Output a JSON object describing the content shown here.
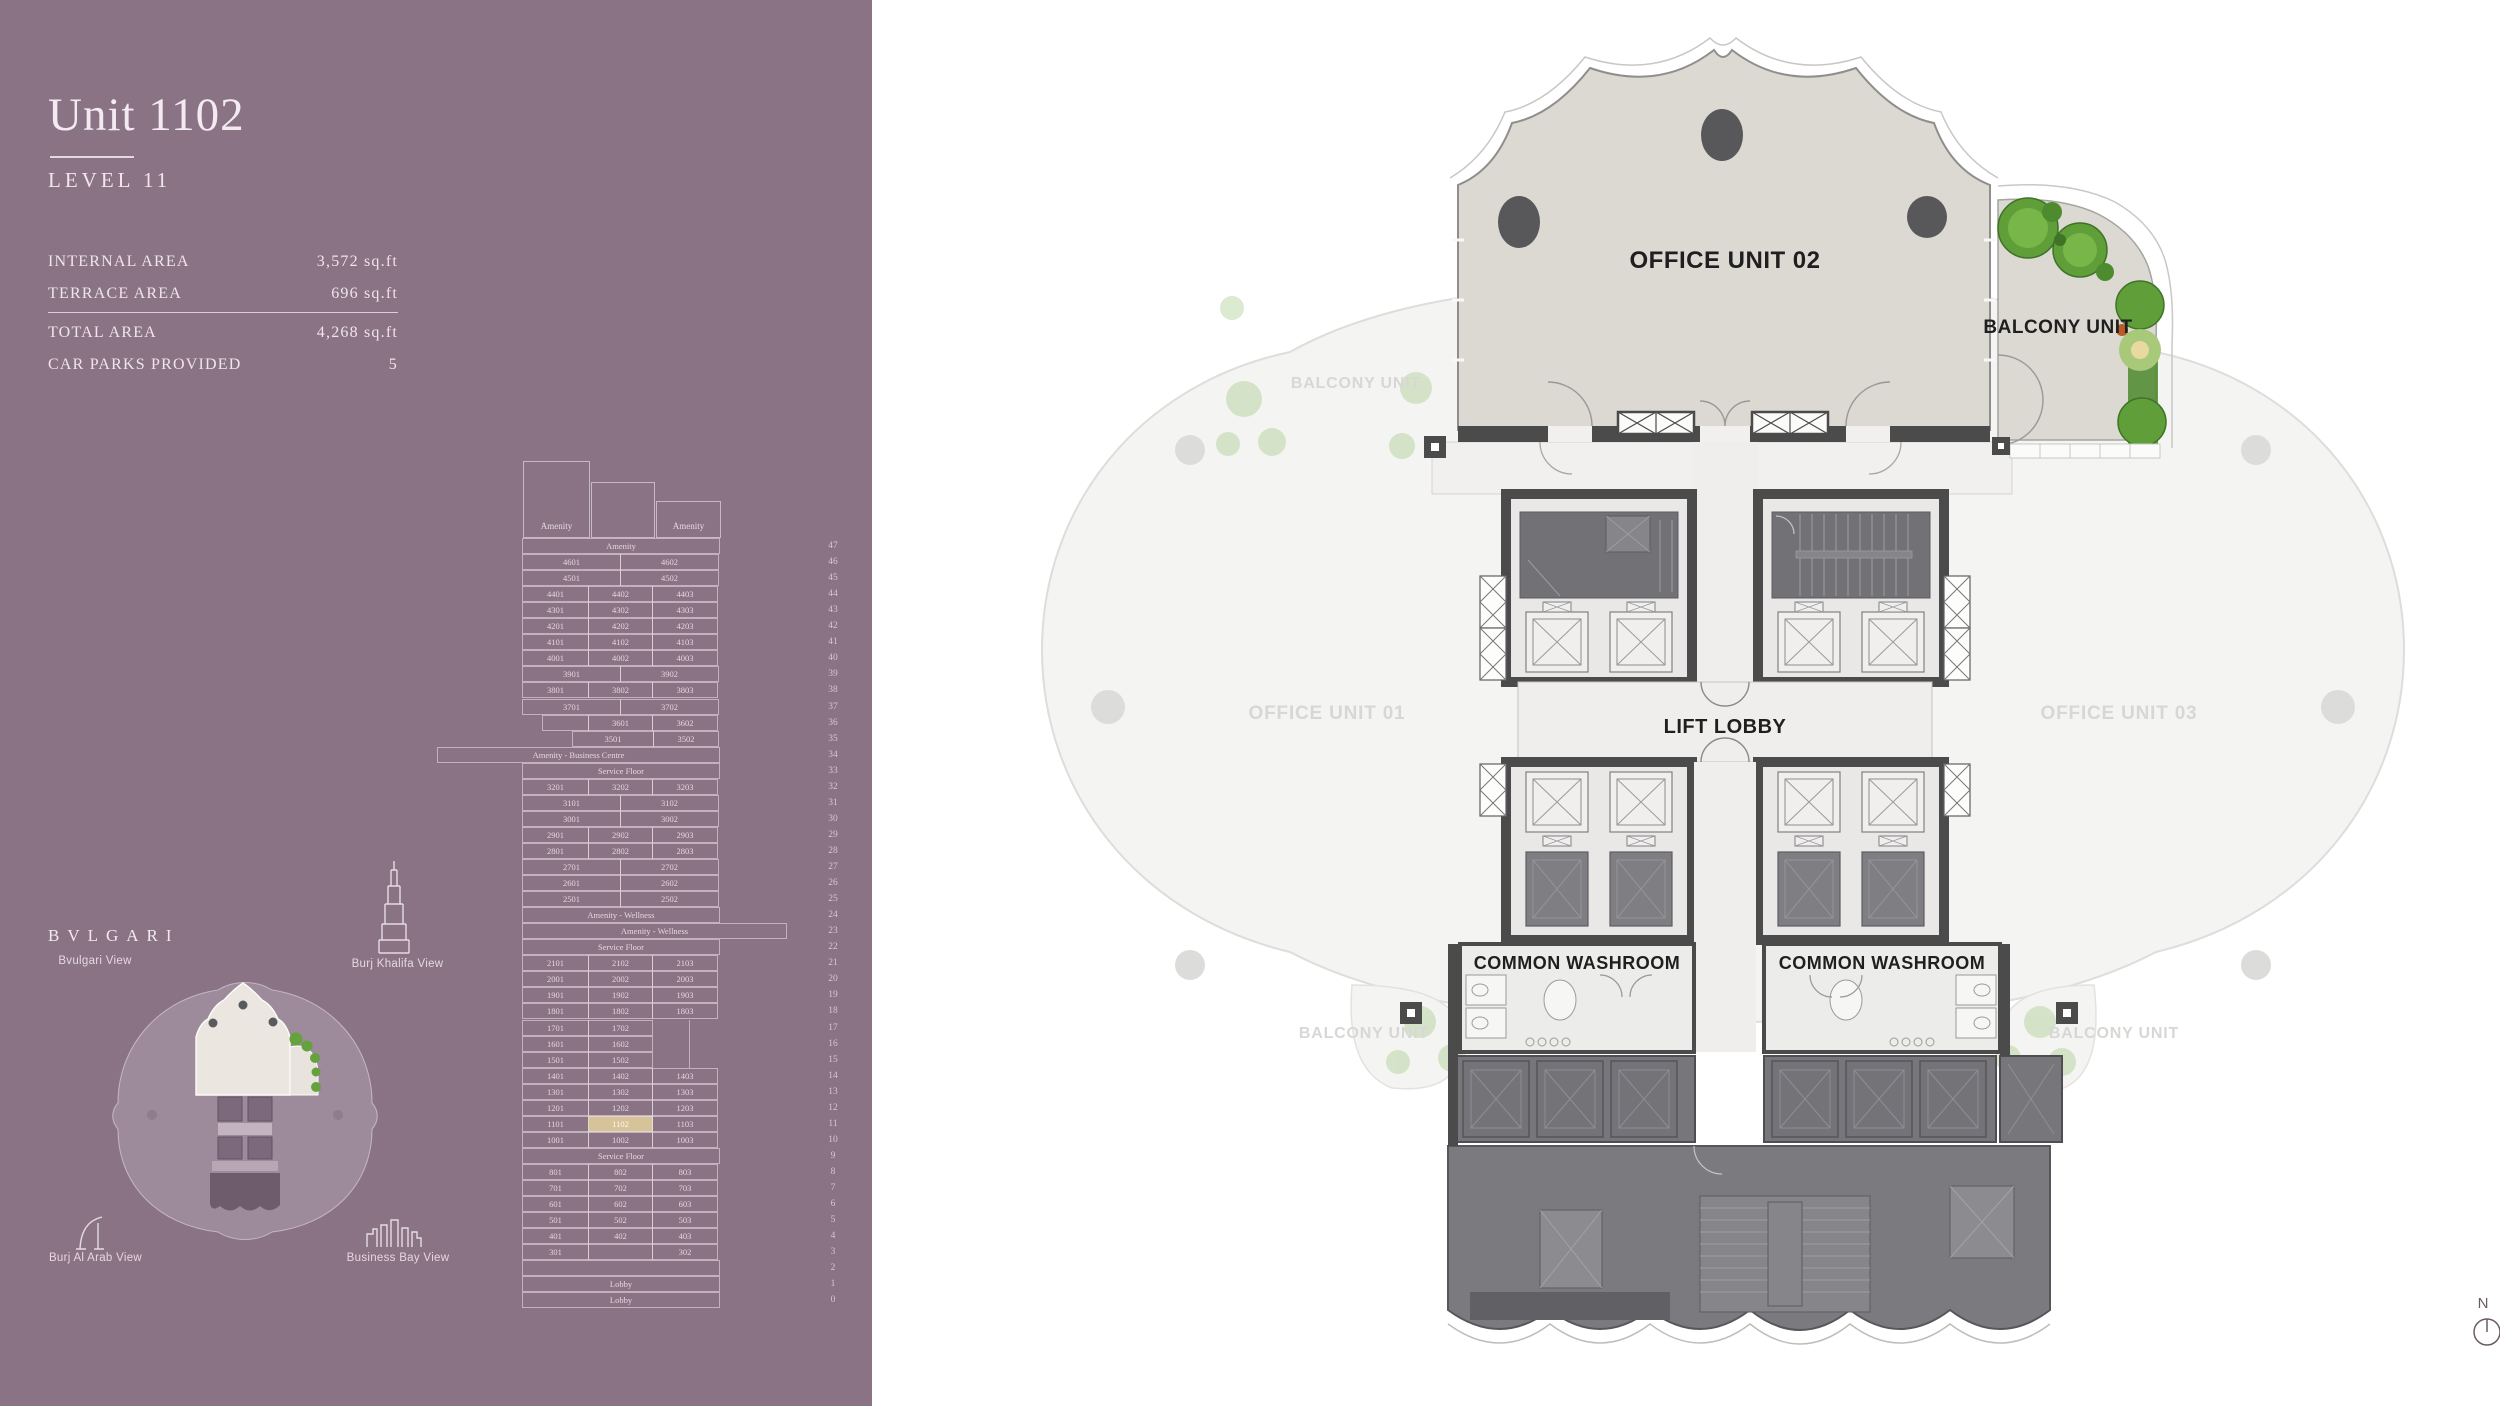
{
  "header": {
    "title": "Unit 1102",
    "level": "LEVEL 11"
  },
  "details": {
    "rows": [
      {
        "label": "INTERNAL AREA",
        "value": "3,572 sq.ft"
      },
      {
        "label": "TERRACE AREA",
        "value": "696 sq.ft"
      },
      {
        "label": "TOTAL AREA",
        "value": "4,268 sq.ft"
      },
      {
        "label": "CAR PARKS PROVIDED",
        "value": "5"
      }
    ]
  },
  "views": {
    "brand": "BVLGARI",
    "bvlgari_view": "Bvulgari View",
    "burj_khalifa_view": "Burj Khalifa View",
    "burj_al_arab_view": "Burj Al Arab View",
    "business_bay_view": "Business Bay View"
  },
  "plan": {
    "office_unit_02": "OFFICE UNIT 02",
    "balcony_unit": "BALCONY UNIT",
    "lift_lobby": "LIFT LOBBY",
    "common_washroom_left": "COMMON WASHROOM",
    "common_washroom_right": "COMMON WASHROOM",
    "office_unit_01_faded": "OFFICE UNIT 01",
    "office_unit_03_faded": "OFFICE UNIT 03",
    "balcony_unit_faded_top_left": "BALCONY UNIT",
    "balcony_unit_faded_bottom_left": "BALCONY UNIT",
    "balcony_unit_faded_bottom_right": "BALCONY UNIT",
    "compass_north": "N"
  },
  "colors": {
    "sidebar_bg": "#8a7385",
    "highlight_unit": "#d7c399",
    "plan_beige": "#dcd8d2",
    "plan_wall_dark": "#4b4b4b",
    "greenery": "#5f9e38"
  },
  "stack": {
    "highlighted_unit": "1102",
    "towers": [
      {
        "label": "Amenity",
        "x": 88,
        "y": 6,
        "w": 67,
        "h": 77
      },
      {
        "label": "",
        "x": 156,
        "y": 27,
        "w": 64,
        "h": 56
      },
      {
        "label": "Amenity",
        "x": 221,
        "y": 46,
        "w": 65,
        "h": 37
      }
    ],
    "rows": [
      {
        "f": "47",
        "o": 0,
        "c": [
          [
            "Amenity",
            198
          ]
        ]
      },
      {
        "f": "46",
        "o": 0,
        "c": [
          [
            "4601",
            99
          ],
          [
            "4602",
            99
          ]
        ]
      },
      {
        "f": "45",
        "o": 0,
        "c": [
          [
            "4501",
            99
          ],
          [
            "4502",
            99
          ]
        ]
      },
      {
        "f": "44",
        "o": 0,
        "c": [
          [
            "4401",
            67
          ],
          [
            "4402",
            65
          ],
          [
            "4403",
            66
          ]
        ]
      },
      {
        "f": "43",
        "o": 0,
        "c": [
          [
            "4301",
            67
          ],
          [
            "4302",
            65
          ],
          [
            "4303",
            66
          ]
        ]
      },
      {
        "f": "42",
        "o": 0,
        "c": [
          [
            "4201",
            67
          ],
          [
            "4202",
            65
          ],
          [
            "4203",
            66
          ]
        ]
      },
      {
        "f": "41",
        "o": 0,
        "c": [
          [
            "4101",
            67
          ],
          [
            "4102",
            65
          ],
          [
            "4103",
            66
          ]
        ]
      },
      {
        "f": "40",
        "o": 0,
        "c": [
          [
            "4001",
            67
          ],
          [
            "4002",
            65
          ],
          [
            "4003",
            66
          ]
        ]
      },
      {
        "f": "39",
        "o": 0,
        "c": [
          [
            "3901",
            99
          ],
          [
            "3902",
            99
          ]
        ]
      },
      {
        "f": "38",
        "o": 0,
        "c": [
          [
            "3801",
            67
          ],
          [
            "3802",
            65
          ],
          [
            "3803",
            66
          ]
        ]
      },
      {
        "f": "37",
        "o": 0,
        "c": [
          [
            "3701",
            99
          ],
          [
            "3702",
            99
          ]
        ]
      },
      {
        "f": "36",
        "o": 20,
        "c": [
          [
            "",
            47
          ],
          [
            "3601",
            65
          ],
          [
            "3602",
            66
          ]
        ]
      },
      {
        "f": "35",
        "o": 50,
        "c": [
          [
            "3501",
            82
          ],
          [
            "3502",
            66
          ]
        ]
      },
      {
        "f": "34",
        "o": -85,
        "c": [
          [
            "Amenity - Business Centre",
            283
          ]
        ]
      },
      {
        "f": "33",
        "o": 0,
        "c": [
          [
            "Service Floor",
            198
          ]
        ]
      },
      {
        "f": "32",
        "o": 0,
        "c": [
          [
            "3201",
            67
          ],
          [
            "3202",
            65
          ],
          [
            "3203",
            66
          ]
        ]
      },
      {
        "f": "31",
        "o": 0,
        "c": [
          [
            "3101",
            99
          ],
          [
            "3102",
            99
          ]
        ]
      },
      {
        "f": "30",
        "o": 0,
        "c": [
          [
            "3001",
            99
          ],
          [
            "3002",
            99
          ]
        ]
      },
      {
        "f": "29",
        "o": 0,
        "c": [
          [
            "2901",
            67
          ],
          [
            "2902",
            65
          ],
          [
            "2903",
            66
          ]
        ]
      },
      {
        "f": "28",
        "o": 0,
        "c": [
          [
            "2801",
            67
          ],
          [
            "2802",
            65
          ],
          [
            "2803",
            66
          ]
        ]
      },
      {
        "f": "27",
        "o": 0,
        "c": [
          [
            "2701",
            99
          ],
          [
            "2702",
            99
          ]
        ]
      },
      {
        "f": "26",
        "o": 0,
        "c": [
          [
            "2601",
            99
          ],
          [
            "2602",
            99
          ]
        ]
      },
      {
        "f": "25",
        "o": 0,
        "c": [
          [
            "2501",
            99
          ],
          [
            "2502",
            99
          ]
        ]
      },
      {
        "f": "24",
        "o": 0,
        "c": [
          [
            "Amenity - Wellness",
            198
          ]
        ]
      },
      {
        "f": "23",
        "o": 0,
        "c": [
          [
            "Amenity - Wellness",
            265
          ]
        ]
      },
      {
        "f": "22",
        "o": 0,
        "c": [
          [
            "Service Floor",
            198
          ]
        ]
      },
      {
        "f": "21",
        "o": 0,
        "c": [
          [
            "2101",
            67
          ],
          [
            "2102",
            65
          ],
          [
            "2103",
            66
          ]
        ]
      },
      {
        "f": "20",
        "o": 0,
        "c": [
          [
            "2001",
            67
          ],
          [
            "2002",
            65
          ],
          [
            "2003",
            66
          ]
        ]
      },
      {
        "f": "19",
        "o": 0,
        "c": [
          [
            "1901",
            67
          ],
          [
            "1902",
            65
          ],
          [
            "1903",
            66
          ]
        ]
      },
      {
        "f": "18",
        "o": 0,
        "c": [
          [
            "1801",
            67
          ],
          [
            "1802",
            65
          ],
          [
            "1803",
            66
          ]
        ]
      },
      {
        "f": "17",
        "o": 0,
        "c": [
          [
            "1701",
            67
          ],
          [
            "1702",
            65
          ]
        ]
      },
      {
        "f": "16",
        "o": 0,
        "c": [
          [
            "1601",
            67
          ],
          [
            "1602",
            65
          ]
        ]
      },
      {
        "f": "15",
        "o": 0,
        "c": [
          [
            "1501",
            67
          ],
          [
            "1502",
            65
          ]
        ]
      },
      {
        "f": "14",
        "o": 0,
        "c": [
          [
            "1401",
            67
          ],
          [
            "1402",
            65
          ],
          [
            "1403",
            66
          ]
        ]
      },
      {
        "f": "13",
        "o": 0,
        "c": [
          [
            "1301",
            67
          ],
          [
            "1302",
            65
          ],
          [
            "1303",
            66
          ]
        ]
      },
      {
        "f": "12",
        "o": 0,
        "c": [
          [
            "1201",
            67
          ],
          [
            "1202",
            65
          ],
          [
            "1203",
            66
          ]
        ]
      },
      {
        "f": "11",
        "o": 0,
        "c": [
          [
            "1101",
            67
          ],
          [
            "1102",
            65,
            true
          ],
          [
            "1103",
            66
          ]
        ]
      },
      {
        "f": "10",
        "o": 0,
        "c": [
          [
            "1001",
            67
          ],
          [
            "1002",
            65
          ],
          [
            "1003",
            66
          ]
        ]
      },
      {
        "f": "9",
        "o": 0,
        "c": [
          [
            "Service Floor",
            198
          ]
        ]
      },
      {
        "f": "8",
        "o": 0,
        "c": [
          [
            "801",
            67
          ],
          [
            "802",
            65
          ],
          [
            "803",
            66
          ]
        ]
      },
      {
        "f": "7",
        "o": 0,
        "c": [
          [
            "701",
            67
          ],
          [
            "702",
            65
          ],
          [
            "703",
            66
          ]
        ]
      },
      {
        "f": "6",
        "o": 0,
        "c": [
          [
            "601",
            67
          ],
          [
            "602",
            65
          ],
          [
            "603",
            66
          ]
        ]
      },
      {
        "f": "5",
        "o": 0,
        "c": [
          [
            "501",
            67
          ],
          [
            "502",
            65
          ],
          [
            "503",
            66
          ]
        ]
      },
      {
        "f": "4",
        "o": 0,
        "c": [
          [
            "401",
            67
          ],
          [
            "402",
            65
          ],
          [
            "403",
            66
          ]
        ]
      },
      {
        "f": "3",
        "o": 0,
        "c": [
          [
            "301",
            67
          ],
          [
            "",
            65
          ],
          [
            "302",
            66
          ]
        ]
      },
      {
        "f": "2",
        "o": 0,
        "c": [
          [
            "",
            198
          ]
        ]
      },
      {
        "f": "1",
        "o": 0,
        "c": [
          [
            "Lobby",
            198
          ]
        ]
      },
      {
        "f": "0",
        "o": 0,
        "c": [
          [
            "Lobby",
            198
          ]
        ]
      }
    ]
  }
}
